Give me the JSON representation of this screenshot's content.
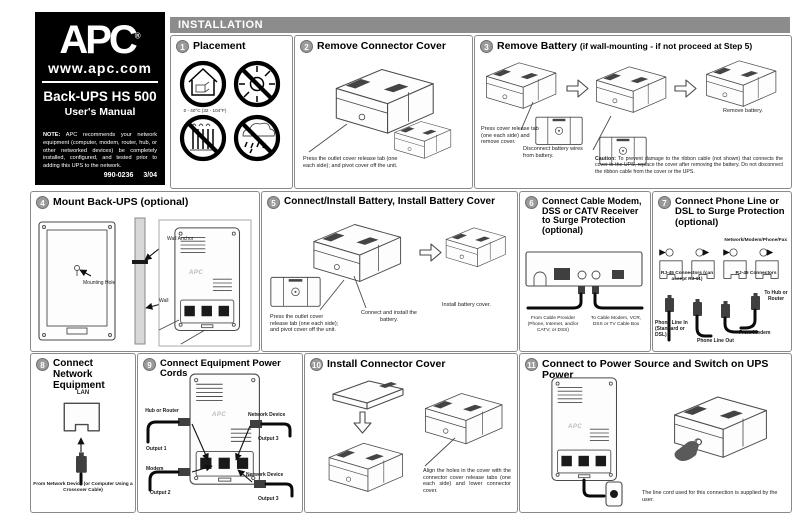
{
  "brand": {
    "logo": "APC",
    "reg": "®",
    "url": "www.apc.com",
    "product": "Back-UPS HS 500",
    "subtitle": "User's Manual",
    "note_label": "NOTE:",
    "note_text": " APC recommends your network equipment (computer, modem, router, hub, or other networked devices) be completely installed, configured, and tested prior to adding this UPS to the network.",
    "doc_number": "990-0236",
    "doc_date": "3/04"
  },
  "header": {
    "title": "INSTALLATION"
  },
  "colors": {
    "header_bar": "#8c8c8c",
    "step_badge": "#9a9a9a",
    "panel_border": "#8a8a8a",
    "brand_panel": "#000000"
  },
  "steps": {
    "s1": {
      "num": "1",
      "title": "Placement",
      "temp_range": "0 - 40°C  (32 - 104°F)"
    },
    "s2": {
      "num": "2",
      "title": "Remove Connector Cover",
      "caption": "Press the outlet cover release tab (one each side); and pivot cover off the unit."
    },
    "s3": {
      "num": "3",
      "title": "Remove Battery",
      "title_suffix": "(if wall-mounting - if not proceed at Step 5)",
      "cap_release": "Press cover release tab (one each side) and remove cover.",
      "cap_disconnect": "Disconnect battery wires from battery.",
      "cap_remove": "Remove battery.",
      "caution_label": "Caution:",
      "caution_text": " To prevent damage to the ribbon cable (not shown) that connects the cover to the UPS, replace the cover after removing the battery. Do not disconnect the ribbon cable from the cover or the UPS."
    },
    "s4": {
      "num": "4",
      "title": "Mount Back-UPS (optional)",
      "lbl_wall_anchor": "Wall Anchor",
      "lbl_mounting_hole": "Mounting Hole",
      "lbl_wall": "Wall"
    },
    "s5": {
      "num": "5",
      "title": "Connect/Install Battery, Install Battery Cover",
      "cap_release": "Press the outlet cover release tab (one each side); and pivot cover off the unit.",
      "cap_connect": "Connect and install the battery.",
      "cap_cover": "Install battery cover."
    },
    "s6": {
      "num": "6",
      "title": "Connect Cable Modem, DSS or CATV Receiver to Surge Protection (optional)",
      "cap_from": "From Cable Provider (Phone, Internet, and/or CATV; or DSS)",
      "cap_to": "To Cable Modem, VCR, DSS or TV Cable Box"
    },
    "s7": {
      "num": "7",
      "title": "Connect Phone Line or DSL to Surge Protection (optional)",
      "lbl_top": "Network/Modem/Phone/Fax",
      "lbl_jacks_left": "RJ-45 Connectors (can accept RJ-11)",
      "lbl_jacks_right": "RJ-45 Connectors",
      "lbl_phone_in": "Phone Line In (Standard or DSL)",
      "lbl_phone_out": "Phone Line Out",
      "lbl_from_modem": "From Modem",
      "lbl_to_hub": "To Hub or Router"
    },
    "s8": {
      "num": "8",
      "title": "Connect Network Equipment",
      "lbl_lan": "LAN",
      "caption": "From Network Device (or Computer Using a Crossover Cable)"
    },
    "s9": {
      "num": "9",
      "title": "Connect Equipment Power Cords",
      "lbl_hub_router": "Hub or Router",
      "lbl_output1": "Output 1",
      "lbl_modem": "Modem",
      "lbl_output2": "Output 2",
      "lbl_network_device_top": "Network Device",
      "lbl_output3_top": "Output 3",
      "lbl_network_device_bottom": "Network Device",
      "lbl_output3_bottom": "Output 3"
    },
    "s10": {
      "num": "10",
      "title": "Install Connector Cover",
      "caption": "Align the holes in the cover with the connector cover release tabs (one each side) and lower connector cover."
    },
    "s11": {
      "num": "11",
      "title": "Connect to Power Source and Switch on UPS Power",
      "caption": "The line cord used for this connection is supplied by the user."
    }
  }
}
